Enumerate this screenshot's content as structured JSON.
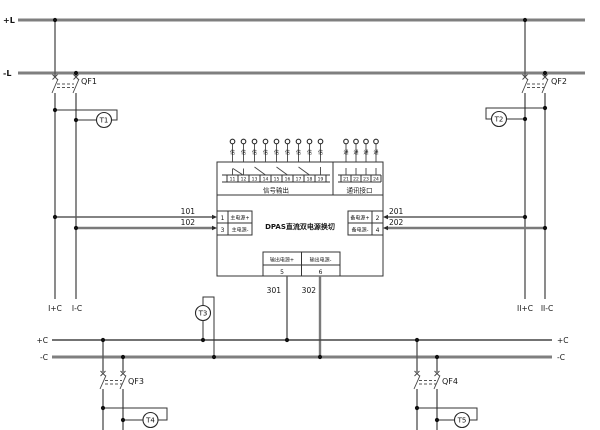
{
  "buses": {
    "plus_l": "+L",
    "minus_l": "-L",
    "plus_c": "+C",
    "minus_c": "-C"
  },
  "breakers": {
    "qf1": "QF1",
    "qf2": "QF2",
    "qf3": "QF3",
    "qf4": "QF4"
  },
  "monitors": {
    "t1": "T1",
    "t2": "T2",
    "t3": "T3",
    "t4": "T4",
    "t5": "T5"
  },
  "wire_labels": {
    "w101": "101",
    "w102": "102",
    "w201": "201",
    "w202": "202",
    "w301": "301",
    "w302": "302"
  },
  "feeder_labels": {
    "sec1_plus": "I+C",
    "sec1_minus": "I-C",
    "sec2_plus": "II+C",
    "sec2_minus": "II-C"
  },
  "device": {
    "title": "DPAS直流双电源换切",
    "signal_group": {
      "label": "信号输出",
      "terminals": [
        "11",
        "12",
        "13",
        "14",
        "15",
        "16",
        "17",
        "18",
        "19"
      ],
      "pins": [
        "信",
        "信",
        "信",
        "信",
        "信",
        "信",
        "信",
        "信",
        "信"
      ]
    },
    "comm_group": {
      "label": "通讯接口",
      "terminals": [
        "21",
        "22",
        "23",
        "24"
      ],
      "pins": [
        "通",
        "通",
        "通",
        "通"
      ]
    },
    "main_input": {
      "terminal_plus": "1",
      "label_plus": "主电源+",
      "terminal_minus": "3",
      "label_minus": "主电源-"
    },
    "backup_input": {
      "terminal_plus": "2",
      "label_plus": "备电源+",
      "terminal_minus": "4",
      "label_minus": "备电源-"
    },
    "output": {
      "label_plus": "输出电源+",
      "terminal_plus": "5",
      "label_minus": "输出电源-",
      "terminal_minus": "6"
    }
  }
}
